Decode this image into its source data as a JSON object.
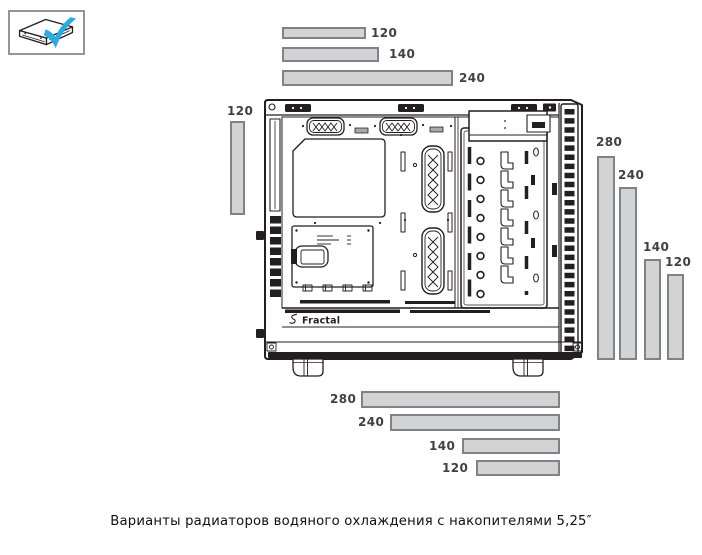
{
  "page": {
    "caption": "Варианты радиаторов водяного охлаждения с накопителями 5,25″"
  },
  "legend": {
    "icon": "odd-5.25-drive-check-icon"
  },
  "case_art": {
    "brand_logo": "Fractal"
  },
  "radiator_bars": {
    "top": [
      {
        "label": "120"
      },
      {
        "label": "140"
      },
      {
        "label": "240"
      }
    ],
    "left": [
      {
        "label": "120"
      }
    ],
    "right": [
      {
        "label": "280"
      },
      {
        "label": "240"
      },
      {
        "label": "140"
      },
      {
        "label": "120"
      }
    ],
    "bottom": [
      {
        "label": "280"
      },
      {
        "label": "240"
      },
      {
        "label": "140"
      },
      {
        "label": "120"
      }
    ]
  },
  "colors": {
    "bar_fill": "#d1d3d4",
    "bar_border": "#808285",
    "label_text": "#414042",
    "line_art": "#231f20",
    "check_blue": "#29abe2",
    "legend_border": "#939598"
  }
}
